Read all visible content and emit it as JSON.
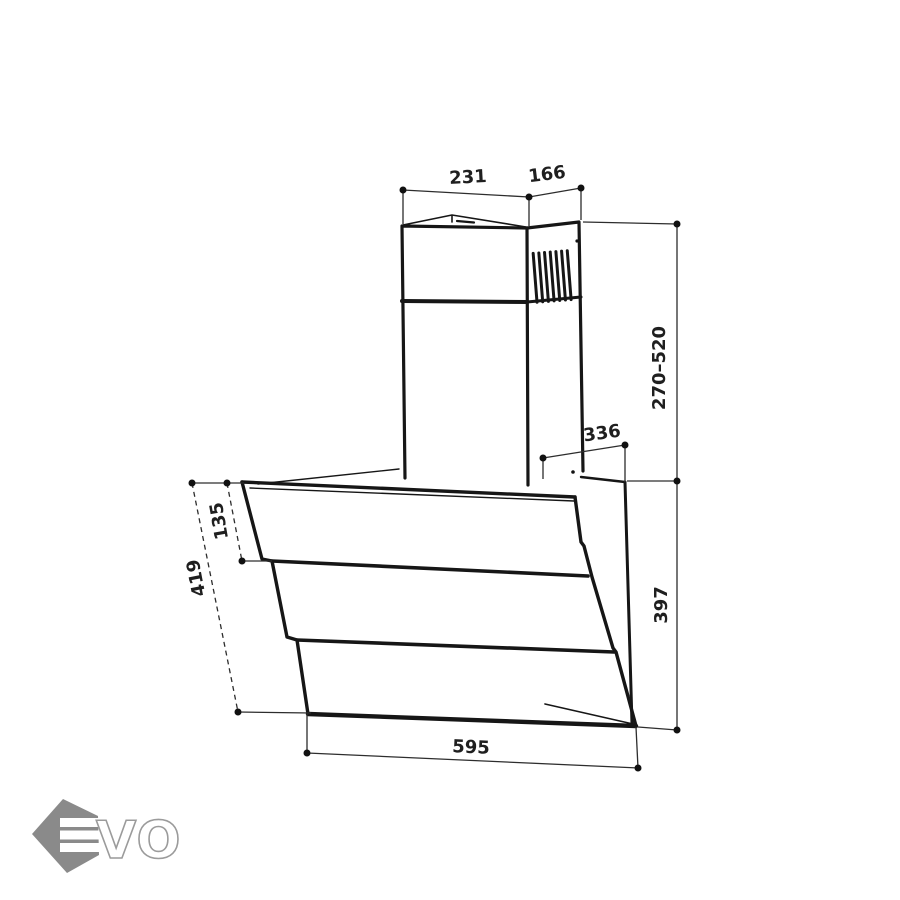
{
  "diagram": {
    "kind": "technical dimension drawing",
    "subject": "wall-mounted angled cooker hood with telescopic chimney",
    "line_color": "#161616",
    "dimension_line_color": "#2d2d2d",
    "background_color": "#ffffff",
    "dimensions": {
      "chimney_width": {
        "value": "231"
      },
      "chimney_depth": {
        "value": "166"
      },
      "chimney_height_range": {
        "value": "270–520"
      },
      "top_depth": {
        "value": "336"
      },
      "body_height_right": {
        "value": "397"
      },
      "body_width_bottom": {
        "value": "595"
      },
      "front_panel_length": {
        "value": "419"
      },
      "front_top_offset": {
        "value": "135"
      }
    }
  },
  "logo": {
    "monogram": "E",
    "wordmark": "VO",
    "hexagon_color": "#8a8a8a",
    "outline_color": "#9b9b9b"
  }
}
